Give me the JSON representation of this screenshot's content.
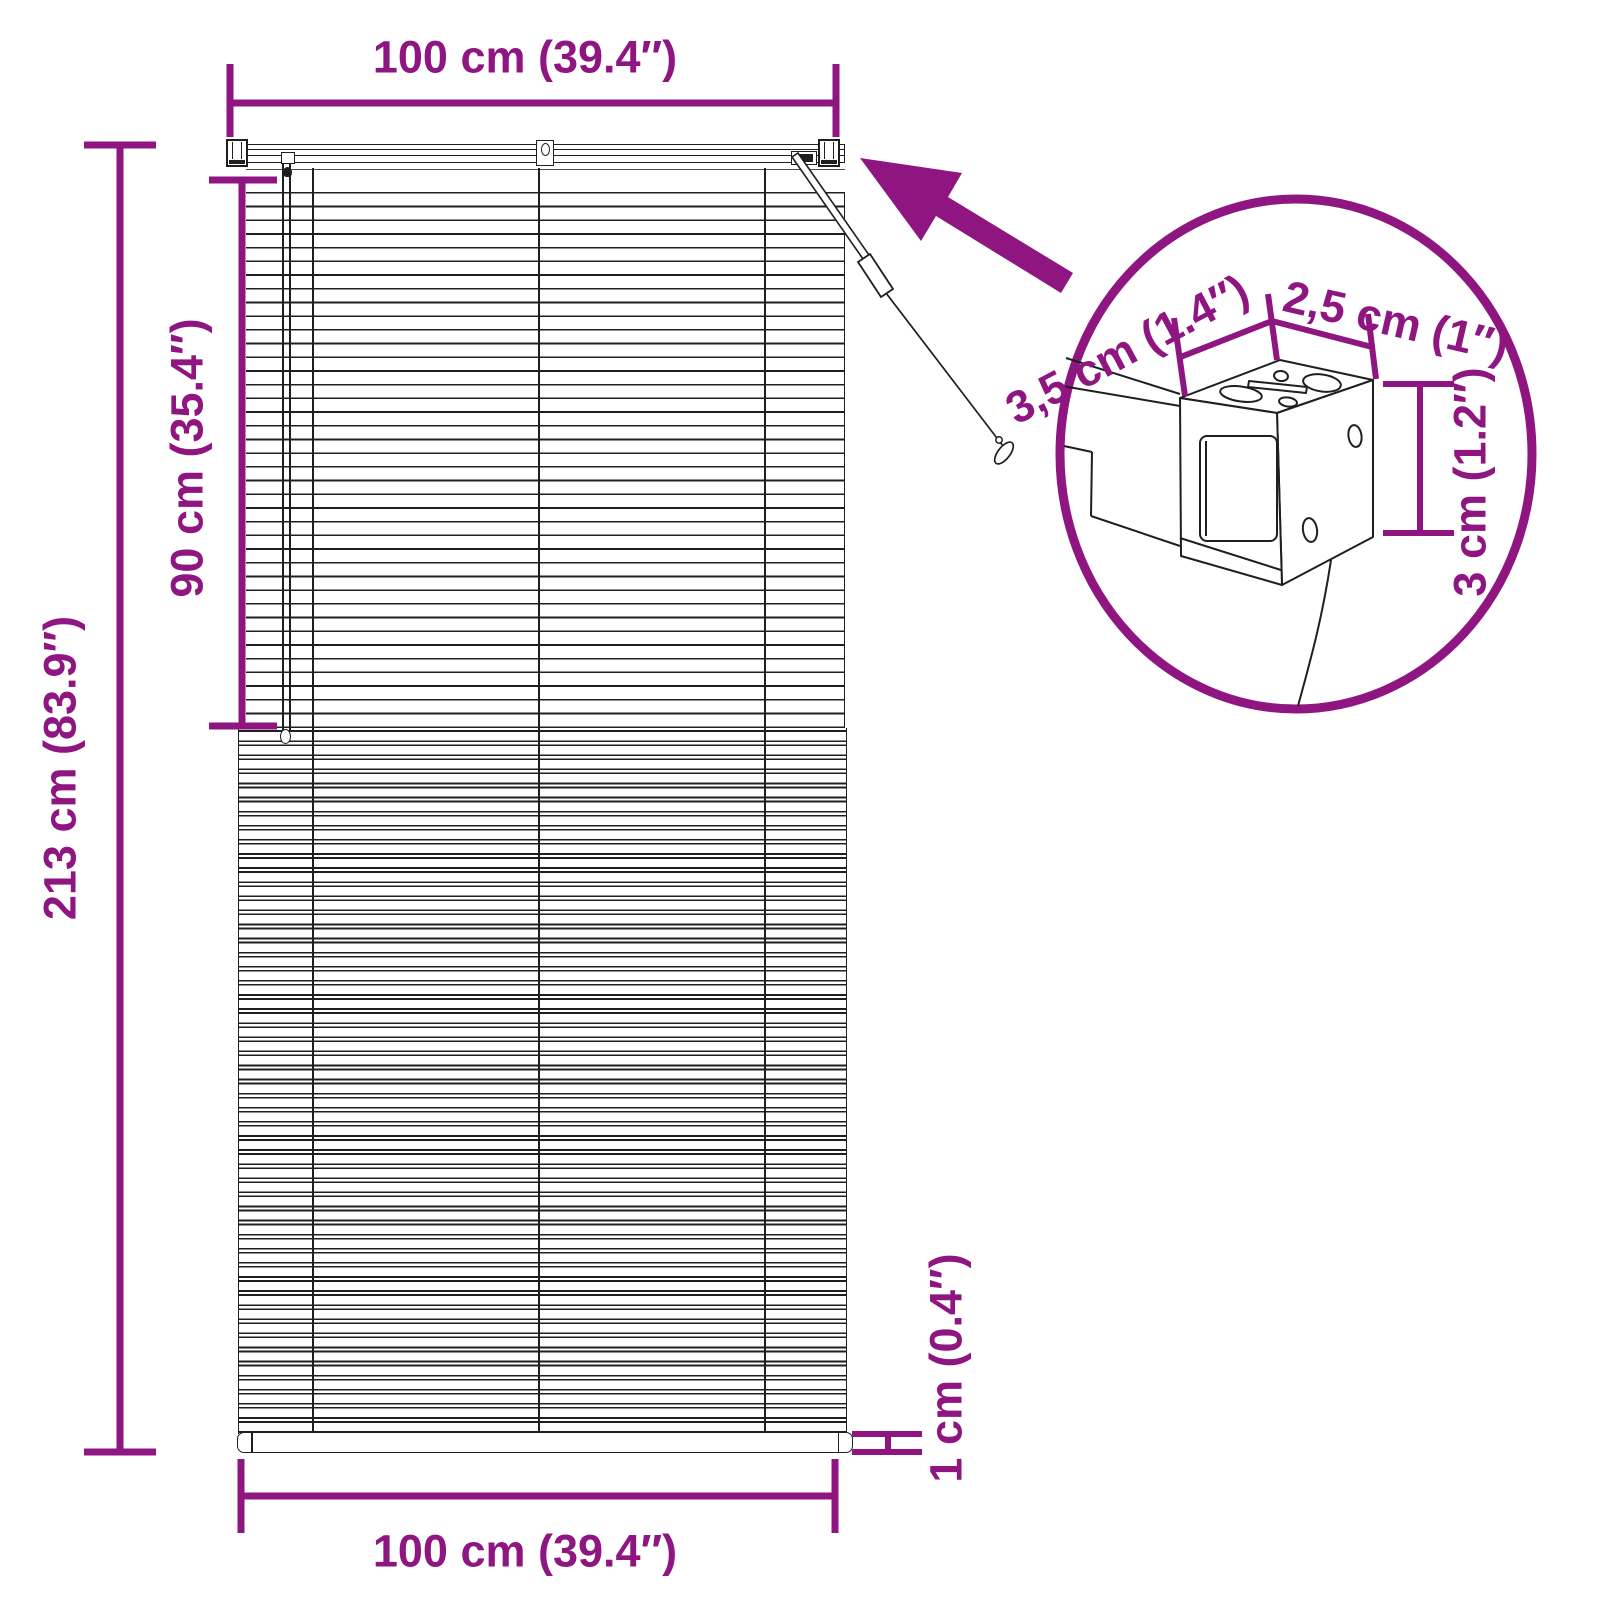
{
  "figure": {
    "kind": "product-dimension-diagram",
    "subject": "horizontal venetian blind with headrail, tilt wand and mounting-bracket detail circle"
  },
  "colors": {
    "accent": "#8F1581",
    "line": "#1f1f1f",
    "background": "#ffffff"
  },
  "labels": {
    "top_width": "100 cm (39.4″)",
    "total_height": "213 cm (83.9″)",
    "raised_height": "90 cm (35.4″)",
    "bottom_width": "100 cm (39.4″)",
    "bottom_rail_height": "1 cm (0.4″)",
    "detail": {
      "bracket_depth": "3,5 cm (1.4″)",
      "bracket_width": "2,5 cm (1″)",
      "bracket_height": "3 cm (1.2″)"
    }
  }
}
